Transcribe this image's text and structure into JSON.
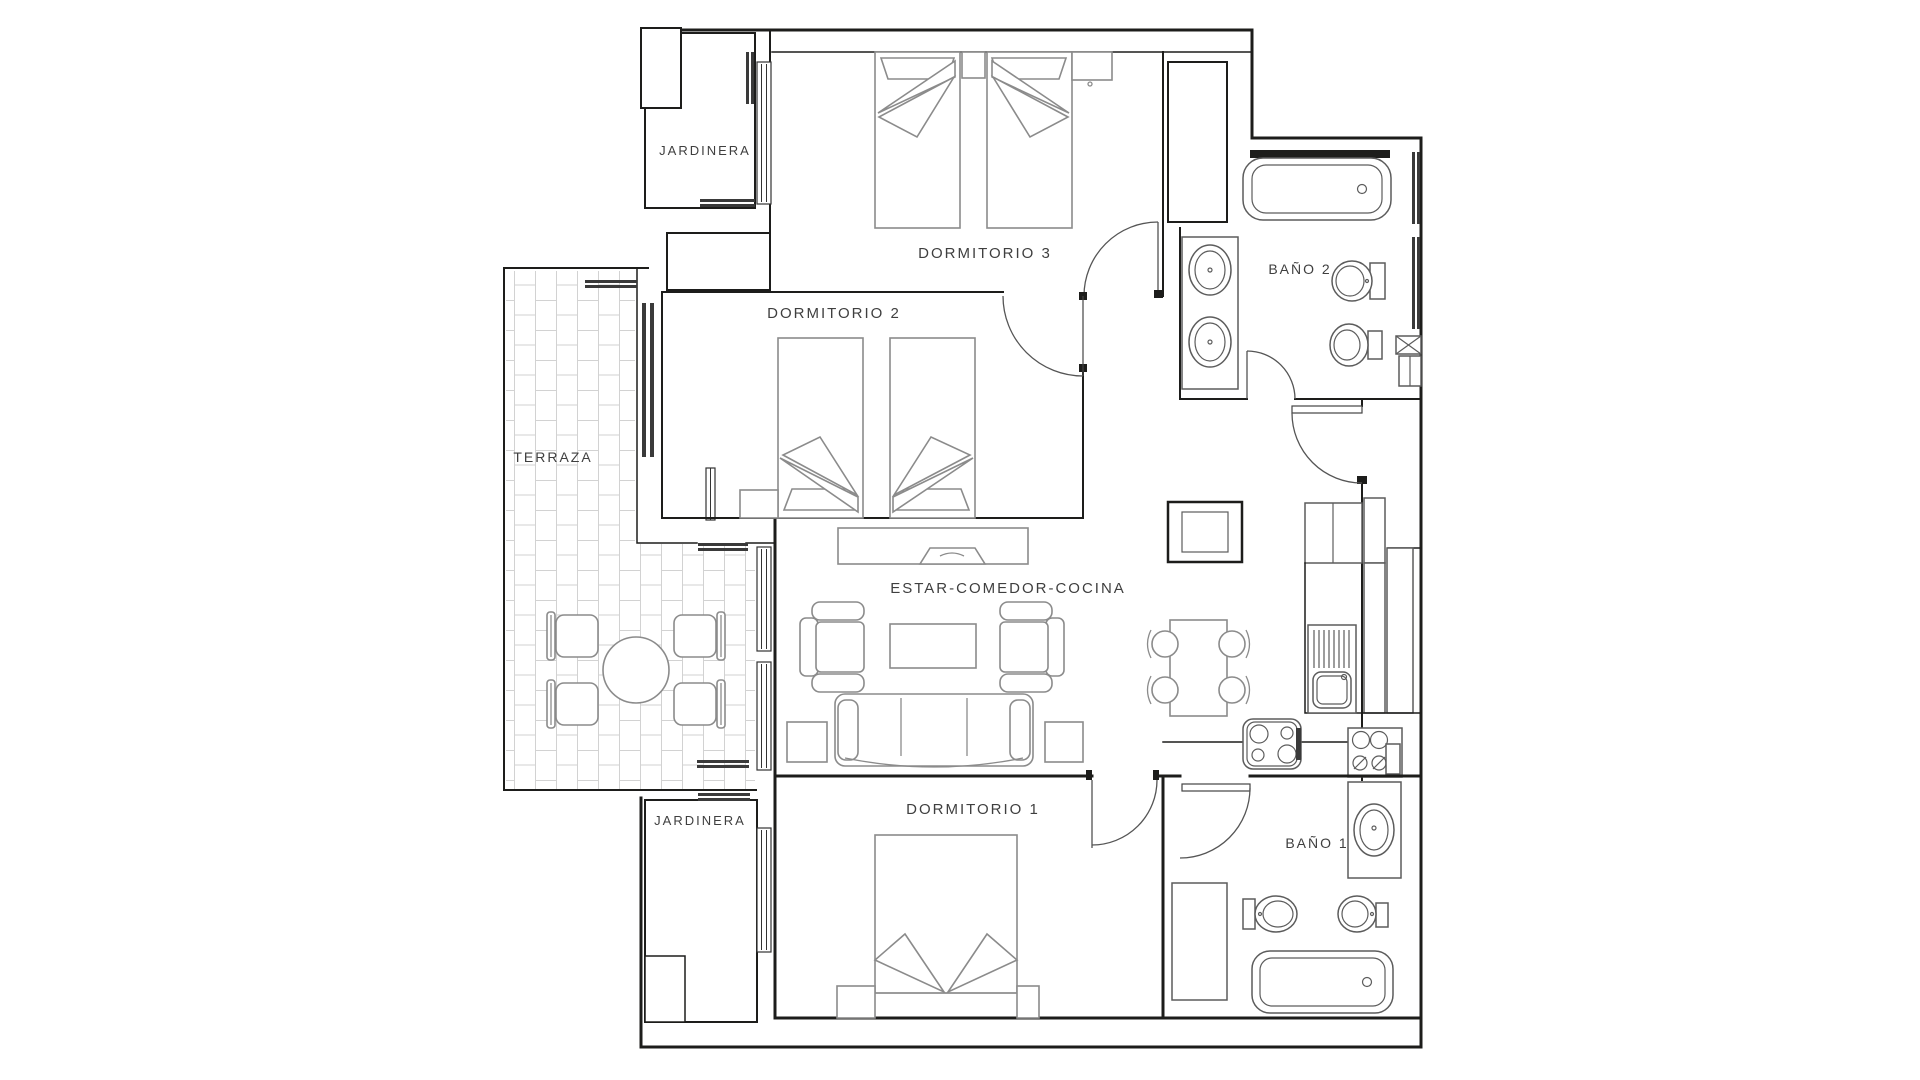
{
  "plan": {
    "type": "apartment-floor-plan",
    "labels": {
      "jardinera_top": "JARDINERA",
      "jardinera_bottom": "JARDINERA",
      "dormitorio3": "DORMITORIO 3",
      "dormitorio2": "DORMITORIO 2",
      "dormitorio1": "DORMITORIO 1",
      "bano2": "BAÑO 2",
      "bano1": "BAÑO 1",
      "terraza": "TERRAZA",
      "estar": "ESTAR-COMEDOR-COCINA"
    },
    "rooms": [
      {
        "name": "Dormitorio 3",
        "furniture": [
          "single-bed",
          "single-bed",
          "nightstand",
          "nightstand"
        ]
      },
      {
        "name": "Dormitorio 2",
        "furniture": [
          "single-bed",
          "single-bed",
          "nightstand",
          "wardrobe"
        ]
      },
      {
        "name": "Dormitorio 1",
        "furniture": [
          "double-bed",
          "nightstand",
          "nightstand",
          "closet"
        ]
      },
      {
        "name": "Baño 2",
        "furniture": [
          "bathtub",
          "double-sink-vanity",
          "toilet",
          "bidet"
        ]
      },
      {
        "name": "Baño 1",
        "furniture": [
          "bathtub",
          "sink-vanity",
          "toilet",
          "bidet",
          "shower-closet"
        ]
      },
      {
        "name": "Estar-Comedor-Cocina",
        "furniture": [
          "sofa",
          "armchair",
          "armchair",
          "coffee-table",
          "tv-cabinet",
          "side-table",
          "side-table",
          "dining-table",
          "chairs",
          "hob",
          "kitchen-sink",
          "counter",
          "fridge",
          "laundry-box"
        ]
      },
      {
        "name": "Terraza",
        "furniture": [
          "round-table",
          "chair",
          "chair",
          "chair",
          "chair"
        ]
      },
      {
        "name": "Jardinera (top)",
        "furniture": []
      },
      {
        "name": "Jardinera (bottom)",
        "furniture": []
      }
    ],
    "colors": {
      "background": "#ffffff",
      "wall": "#1d1d1b",
      "furniture_outline": "#8b8b8b",
      "fixture_outline": "#5c5c5c",
      "window_bar": "#3a3a3a",
      "tile_joint": "#d2d2d2",
      "speckle": "#b8b8b8",
      "label_text": "#3f3f3f"
    }
  }
}
